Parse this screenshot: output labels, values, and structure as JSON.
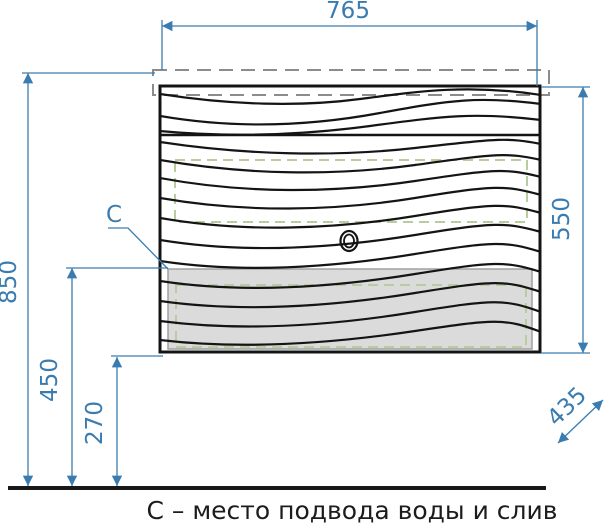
{
  "figure": {
    "caption": "С – место подвода воды и слив",
    "marker_label": "С",
    "dimensions": {
      "width": "765",
      "total_height": "850",
      "body_height": "550",
      "water_supply_height": "450",
      "clearance_height": "270",
      "depth": "435"
    },
    "colors": {
      "dimension_blue": "#3a7cb0",
      "outline_black": "#141414",
      "highlight_green": "#b7cd9d",
      "panel_gray_fill": "#dbdbdb",
      "panel_gray_border": "#a0a0a0",
      "countertop_dash_gray": "#8c8c8c",
      "ground_black": "#16181a"
    }
  }
}
